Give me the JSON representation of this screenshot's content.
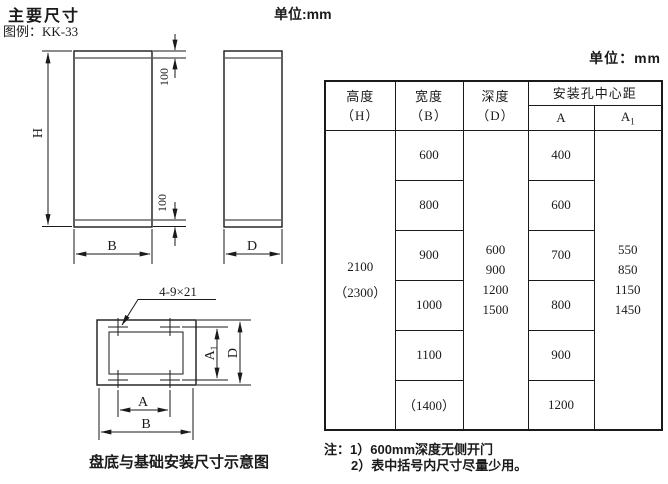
{
  "page": {
    "title": "主要尺寸",
    "legend": "图例：KK-33",
    "unit_top": "单位:mm",
    "unit_table": "单位：mm"
  },
  "colors": {
    "ink": "#1a1a1a",
    "panel_line": "#8f8f8f"
  },
  "drawings": {
    "front": {
      "h": "H",
      "b": "B",
      "top100": "100",
      "bottom100": "100"
    },
    "side": {
      "d": "D"
    },
    "base": {
      "holes": "4-9×21",
      "a": "A",
      "b": "B",
      "a1_base": "A",
      "a1_sub": "1",
      "d": "D",
      "caption": "盘底与基础安装尺寸示意图"
    }
  },
  "table": {
    "headers": {
      "height_line1": "高度",
      "height_line2": "（H）",
      "width_line1": "宽度",
      "width_line2": "（B）",
      "depth_line1": "深度",
      "depth_line2": "（D）",
      "hole_span": "安装孔中心距",
      "a": "A",
      "a1_base": "A",
      "a1_sub": "1"
    },
    "height_cell": [
      "2100",
      "（2300）"
    ],
    "width_cells": [
      "600",
      "800",
      "900",
      "1000",
      "1100",
      "（1400）"
    ],
    "depth_cell": [
      "600",
      "900",
      "1200",
      "1500"
    ],
    "a_cells": [
      "400",
      "600",
      "700",
      "800",
      "900",
      "1200"
    ],
    "a1_cell": [
      "550",
      "850",
      "1150",
      "1450"
    ]
  },
  "notes": {
    "line1": "注：1）600mm深度无侧开门",
    "line2": "2）表中括号内尺寸尽量少用。"
  }
}
